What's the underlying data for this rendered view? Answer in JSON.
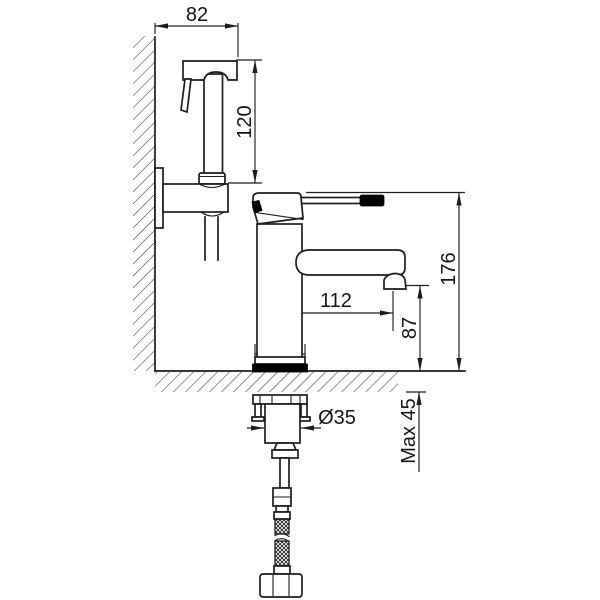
{
  "drawing": {
    "title": "Basin mixer with hand-held bidet sprayer - installation dimension drawing",
    "labels": {
      "sprayer_holder_width": "82",
      "sprayer_height": "120",
      "faucet_total_height": "176",
      "spout_reach": "112",
      "spout_outlet_height": "87",
      "base_diameter": "Ø50",
      "shank_diameter": "Ø35",
      "max_deck_thickness": "Max 45"
    },
    "colors": {
      "line": "#1d1d1d",
      "accent_fill": "#000000",
      "background": "#ffffff"
    }
  }
}
